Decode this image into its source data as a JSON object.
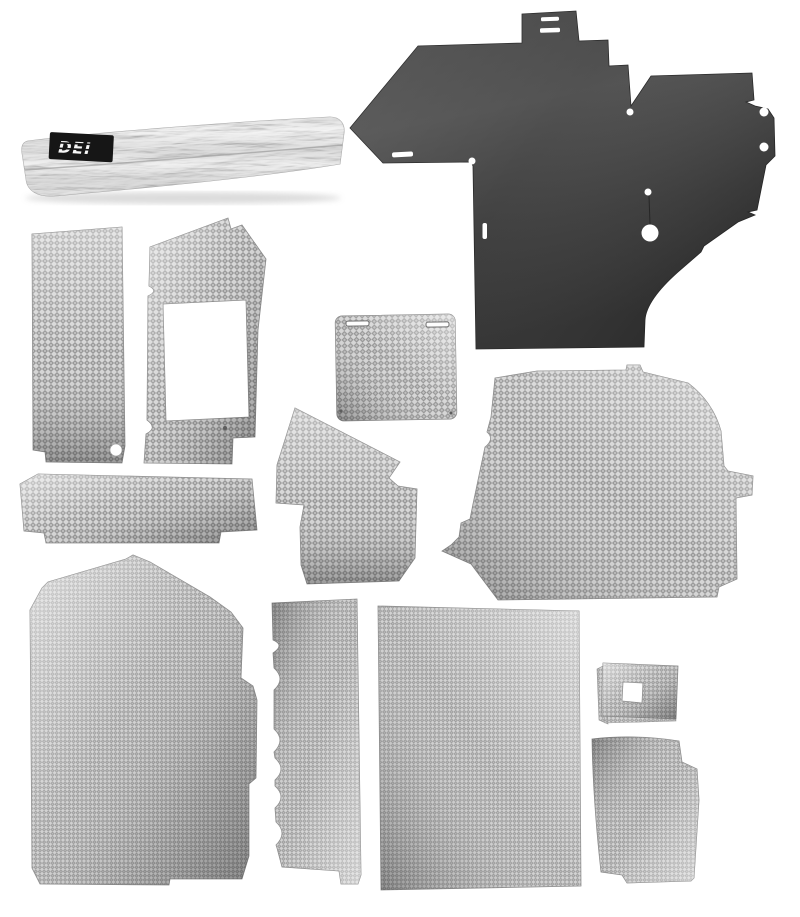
{
  "meta": {
    "type": "product-photo",
    "description": "Automotive heat and sound insulation kit: one rolled reflective foil section with DEI logo tag, one large dark rubberized barrier panel with slots and holes, and eleven pre-cut silver mesh-textured heat shield panels arranged on a white background",
    "background_color": "#ffffff"
  },
  "brand": {
    "logo_text": "DEI",
    "logo_background": "#161616",
    "logo_text_color": "#f7f7f7"
  },
  "palette": {
    "mesh_light": "#d4d4d4",
    "mesh_dark": "#8d8d8d",
    "mesh_mid": "#bdbdbd",
    "barrier_light": "#4f4f4f",
    "barrier_dark": "#303030",
    "foil_light": "#efefef",
    "foil_shadow": "#9d9d9d",
    "cut_edge": "#8a8a8a"
  },
  "pieces": [
    {
      "id": "foil-roll",
      "label": "Rolled reflective foil insulation with DEI logo tag"
    },
    {
      "id": "barrier-panel",
      "label": "Large dark firewall barrier panel with tab, slots and bolt holes"
    },
    {
      "id": "side-panel-left",
      "label": "Tall mesh side panel with corner hole"
    },
    {
      "id": "cutout-frame-panel",
      "label": "Mesh panel with large rectangular cutout"
    },
    {
      "id": "cover-panel",
      "label": "Small mesh cover panel with two top slots"
    },
    {
      "id": "corner-panel",
      "label": "Angular mesh corner panel"
    },
    {
      "id": "lower-strip",
      "label": "Wide mesh strip with notched corners"
    },
    {
      "id": "quarter-panel",
      "label": "Large mesh quarter panel with right-side tab"
    },
    {
      "id": "floor-panel",
      "label": "Large mesh floor panel with top peak"
    },
    {
      "id": "scalloped-strip",
      "label": "Narrow mesh strip with scalloped left edge"
    },
    {
      "id": "rect-panel",
      "label": "Large rectangular mesh panel"
    },
    {
      "id": "square-grommet-panel",
      "label": "Small square mesh panel with square hole"
    },
    {
      "id": "corner-wrap-panel",
      "label": "Curved mesh corner panel with stepped edge"
    }
  ]
}
